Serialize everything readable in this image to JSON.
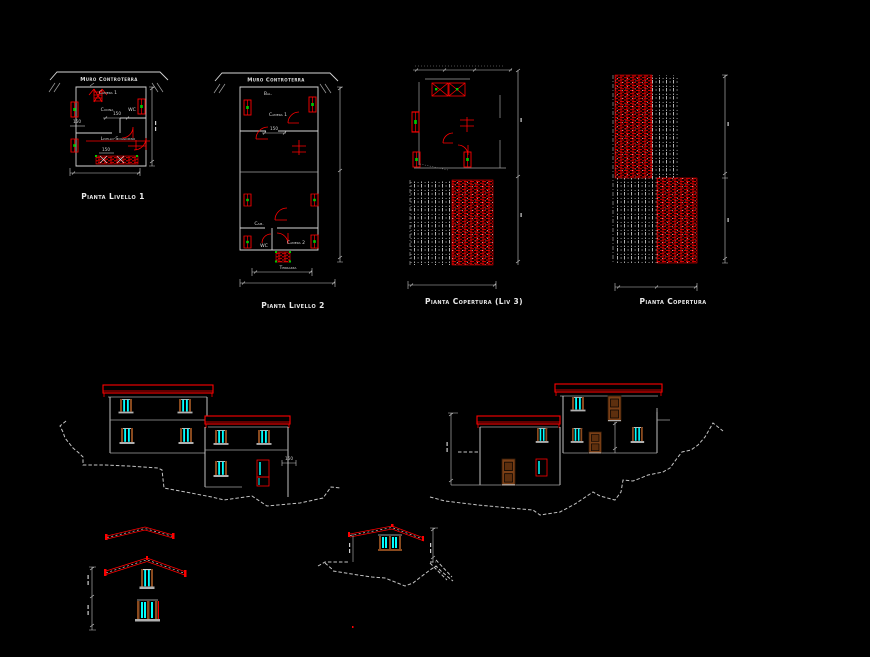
{
  "colors": {
    "background": "#000000",
    "line_white": "#e0e0e0",
    "cad_red": "#ff0000",
    "glass_cyan": "#00ffff",
    "frame_brown": "#8a4a1e",
    "accent_green": "#00c800",
    "sill_gray": "#b0b0b0"
  },
  "plan_level1": {
    "wall_label": "Muro Controterra",
    "caption": "Pianta Livello 1",
    "rooms": {
      "camera": "Camera 1",
      "cucina": "Cucina",
      "wc": "WC",
      "soggiorno": "Livello-Soggiorno"
    },
    "dims": {
      "left": "150",
      "center": "150",
      "bottom": "150"
    }
  },
  "plan_level2": {
    "wall_label": "Muro Controterra",
    "caption": "Pianta Livello 2",
    "rooms": {
      "balcone": "Bal.",
      "camera1": "Camera 1",
      "cam": "Cam.",
      "wc": "WC",
      "camera2": "Camera 2",
      "terrazza": "Terrazza"
    },
    "dims": {
      "center": "150"
    }
  },
  "roof_plan_small": {
    "caption": "Pianta Copertura (Liv 3)"
  },
  "roof_plan_large": {
    "caption": "Pianta Copertura"
  },
  "elevation_left": {
    "dims": {
      "note": "150"
    }
  }
}
